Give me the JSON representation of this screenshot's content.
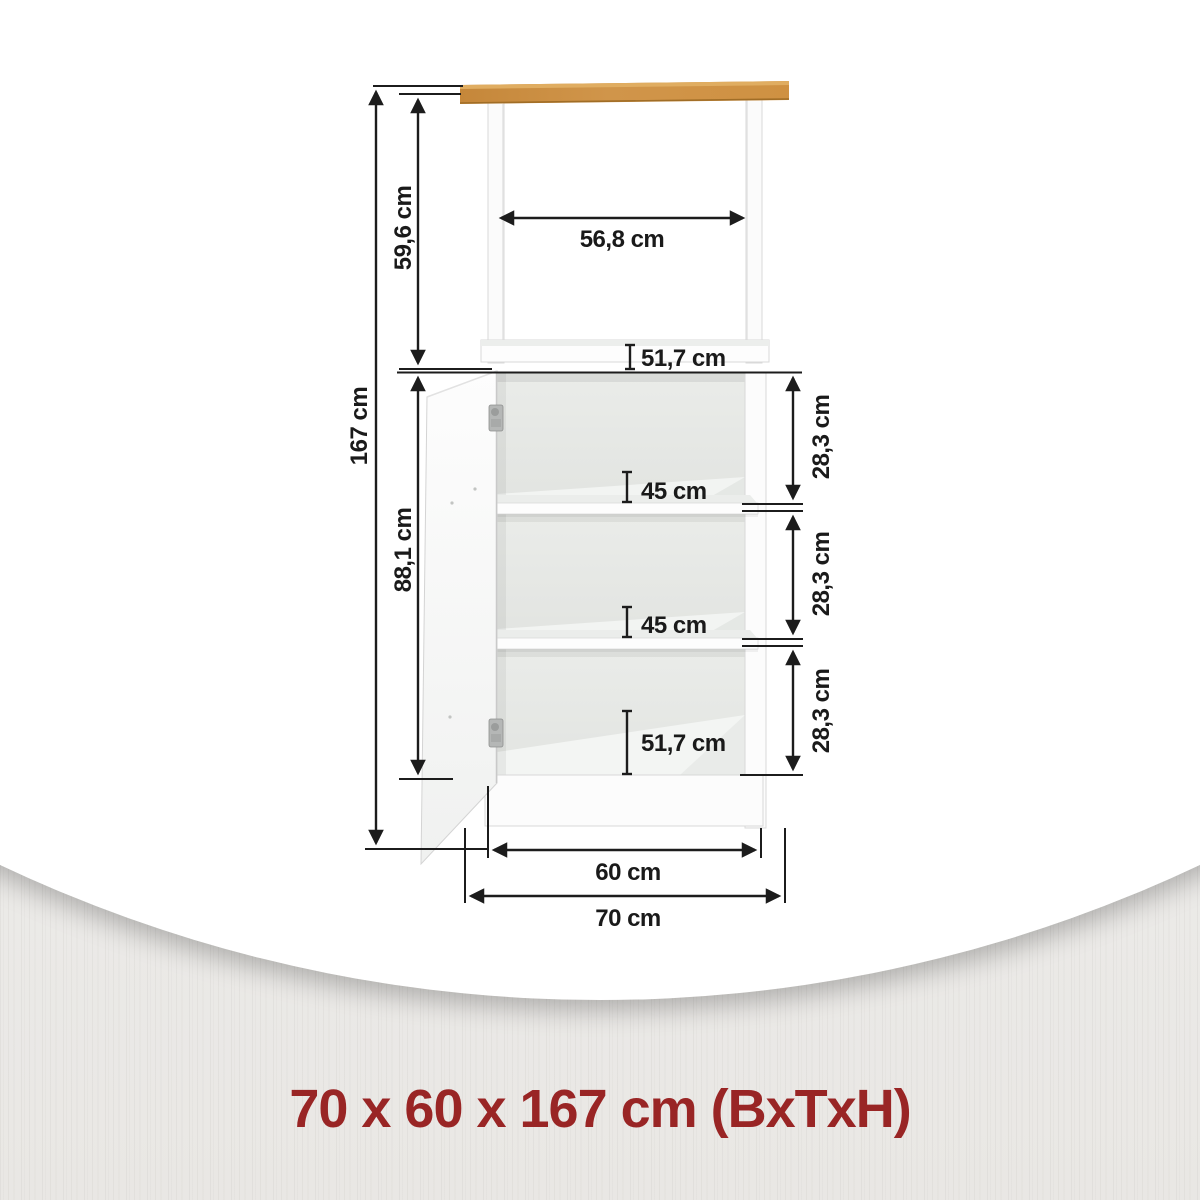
{
  "page": {
    "caption": "70 x 60 x 167 cm (BxTxH)",
    "caption_color": "#992525"
  },
  "diagram": {
    "kind": "cabinet-dimension-drawing",
    "labels": {
      "total_height": "167 cm",
      "niche_height": "59,6 cm",
      "niche_width": "56,8 cm",
      "niche_depth": "51,7 cm",
      "interior_height": "88,1 cm",
      "shelf_depth_1": "45 cm",
      "shelf_depth_2": "45 cm",
      "base_depth": "51,7 cm",
      "compartment_height_1": "28,3 cm",
      "compartment_height_2": "28,3 cm",
      "compartment_height_3": "28,3 cm",
      "inner_width": "60 cm",
      "outer_width": "70 cm"
    },
    "colors": {
      "worktop_wood": "#cd9243",
      "dimension_line": "#1c1c1c",
      "body_white": "#ffffff"
    }
  }
}
